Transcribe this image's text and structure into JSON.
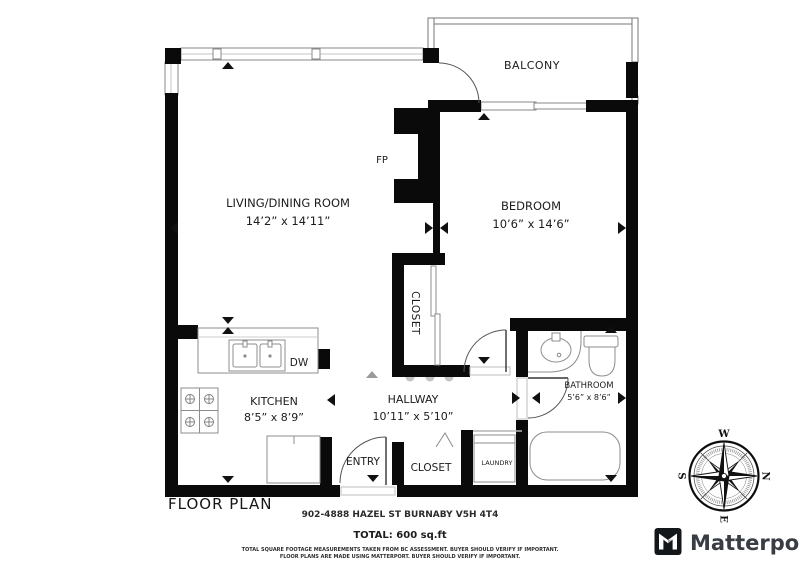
{
  "plan": {
    "title": "FLOOR PLAN",
    "address": "902-4888 HAZEL ST BURNABY V5H 4T4",
    "total_area": "TOTAL: 600 sq.ft",
    "disclaimers": [
      "TOTAL SQUARE FOOTAGE MEASUREMENTS TAKEN FROM BC ASSESSMENT. BUYER SHOULD VERIFY IF IMPORTANT.",
      "FLOOR PLANS ARE MADE USING MATTERPORT. BUYER SHOULD VERIFY IF IMPORTANT."
    ],
    "rooms": {
      "balcony": {
        "name": "BALCONY"
      },
      "living_dining": {
        "name": "LIVING/DINING ROOM",
        "dimensions": "14’2” x 14’11”"
      },
      "bedroom": {
        "name": "BEDROOM",
        "dimensions": "10’6” x 14’6”"
      },
      "bedroom_closet": {
        "name": "CLOSET"
      },
      "kitchen": {
        "name": "KITCHEN",
        "dimensions": "8’5” x 8’9”"
      },
      "hallway": {
        "name": "HALLWAY",
        "dimensions": "10’11” x 5’10”"
      },
      "entry": {
        "name": "ENTRY"
      },
      "entry_closet": {
        "name": "CLOSET"
      },
      "laundry": {
        "name": "LAUNDRY"
      },
      "bathroom": {
        "name": "BATHROOM",
        "dimensions": "5’6” x 8’6”"
      }
    },
    "annotations": {
      "fireplace": "FP",
      "dishwasher": "DW"
    }
  },
  "compass": {
    "north": "N",
    "east": "E",
    "south": "S",
    "west": "W"
  },
  "branding": {
    "wordmark": "Matterport"
  },
  "colors": {
    "wall": "#0a0a0a",
    "line": "#8c8c8c",
    "text": "#1c1c1c",
    "brand_text": "#383d43"
  }
}
